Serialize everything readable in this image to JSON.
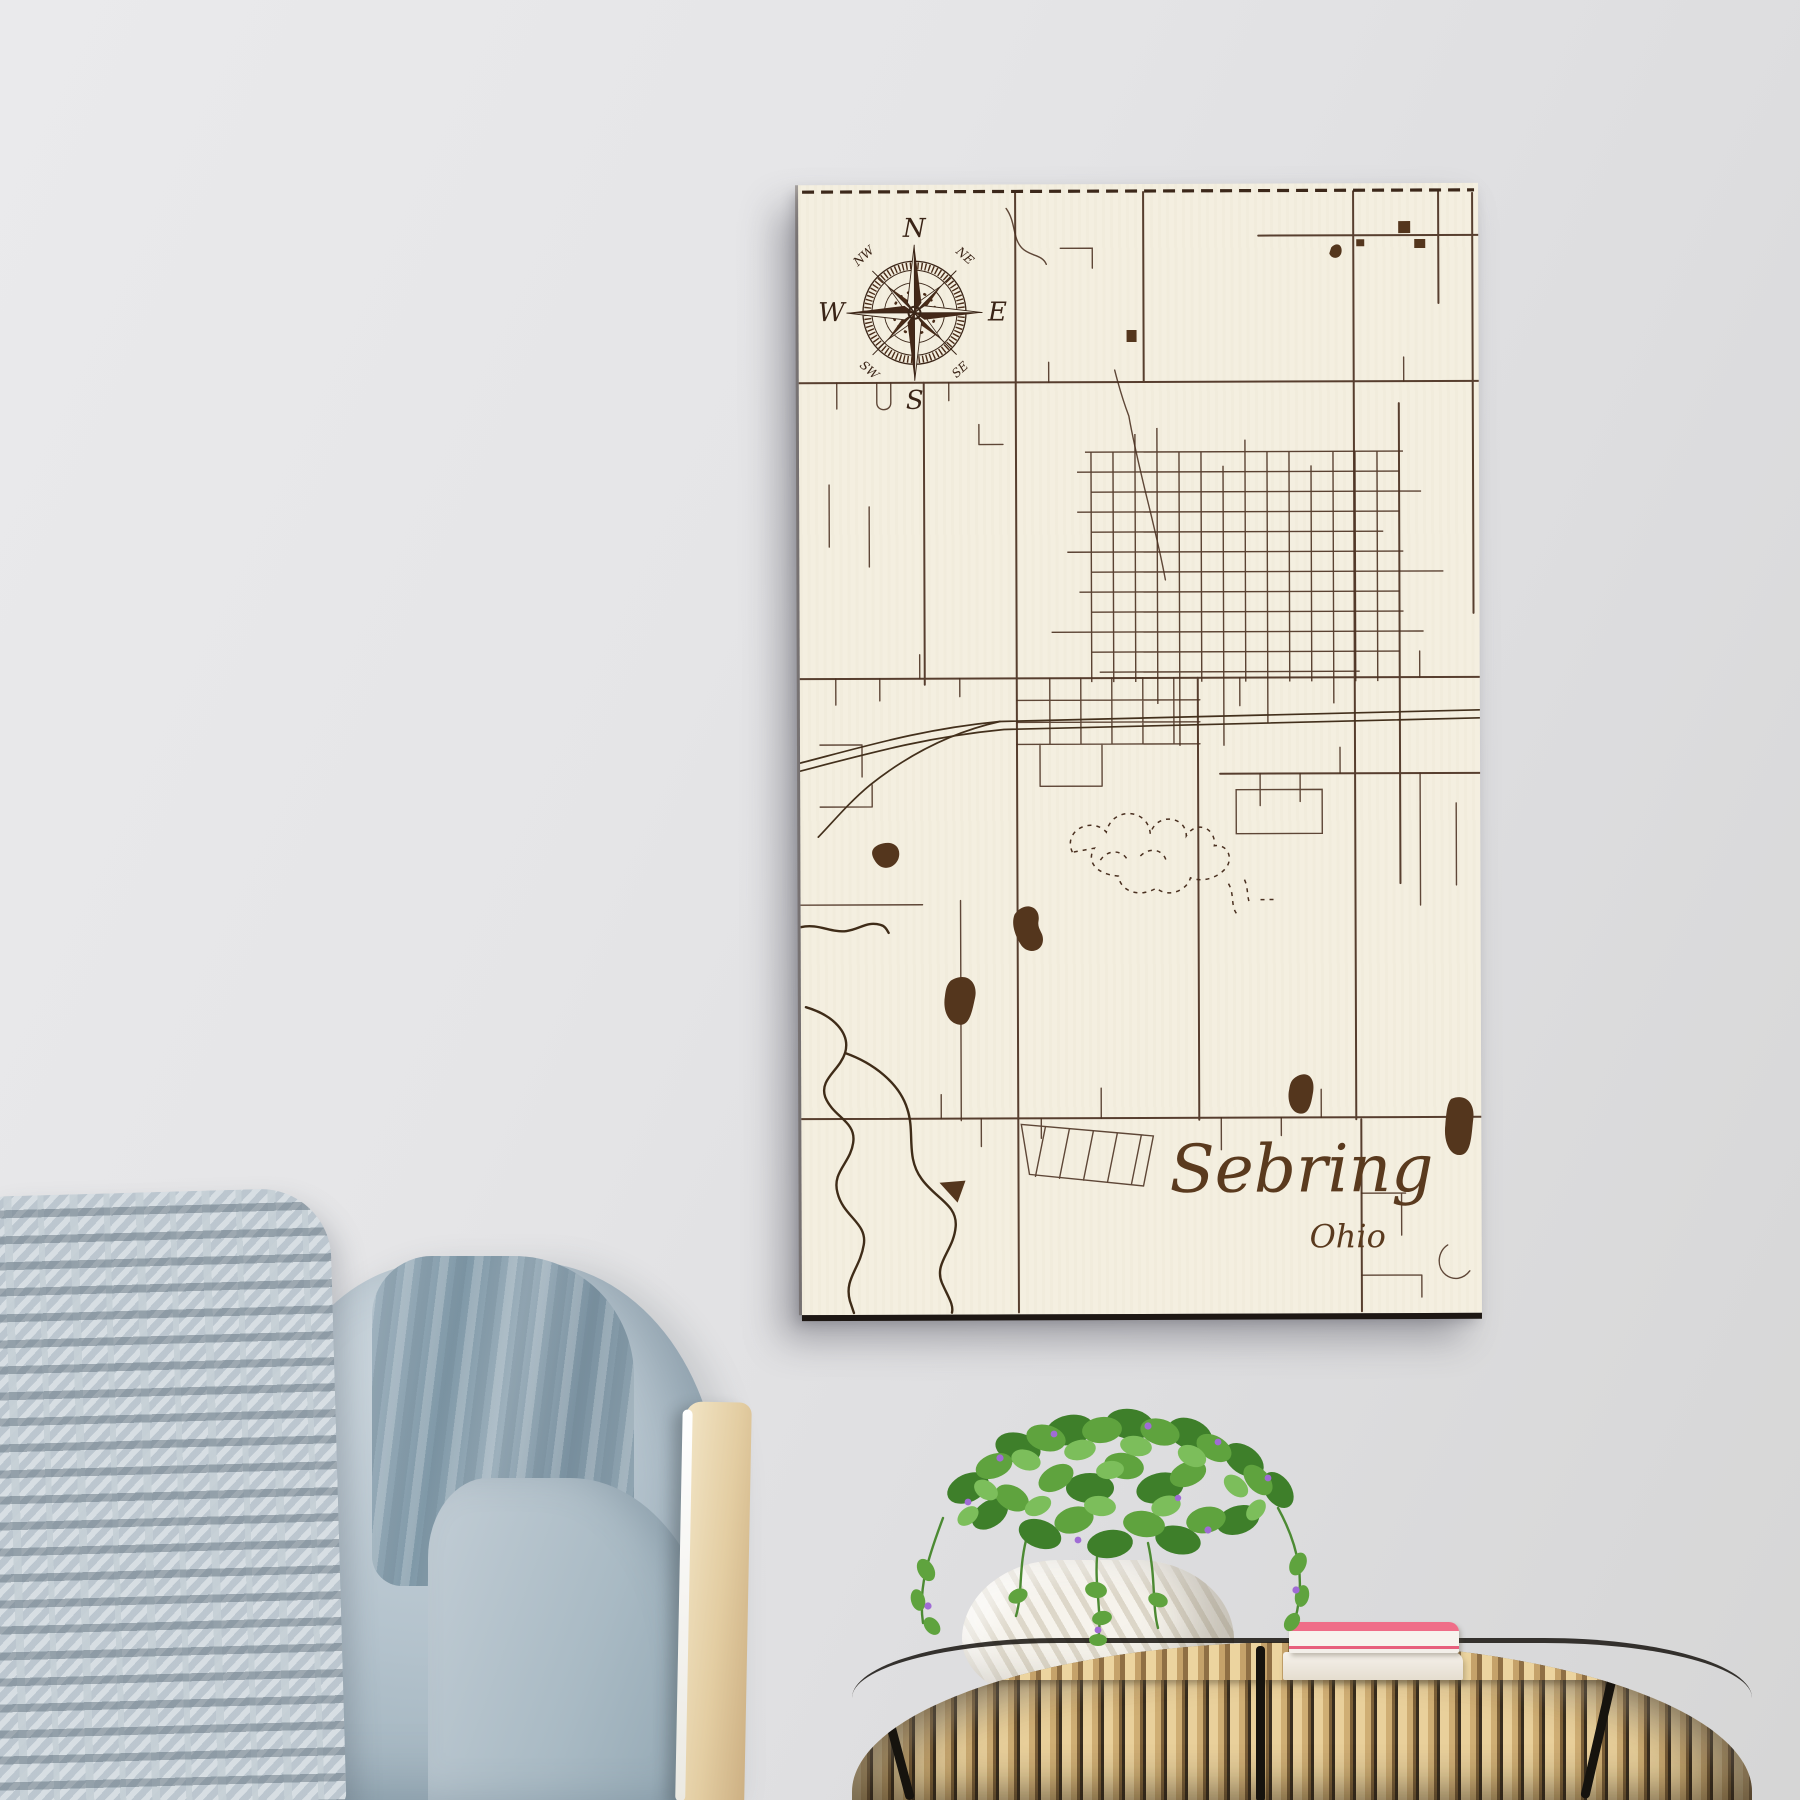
{
  "artwork": {
    "title": "Sebring",
    "subtitle": "Ohio",
    "compass": {
      "n": "N",
      "e": "E",
      "s": "S",
      "w": "W",
      "nw": "NW",
      "ne": "NE",
      "sw": "SW",
      "se": "SE"
    },
    "colors": {
      "board_cream": "#f4efe0",
      "engraving_brown": "#4a3020",
      "walnut_dark": "#54361d",
      "edge_dark": "#1d1713"
    }
  },
  "scene": {
    "wall_color": "#e4e4e6",
    "couch": {
      "knit_pillow_color": "#c6d0d7",
      "cushion_color": "#a9bac5",
      "slub_pillow_color": "#8099a8",
      "frame_wood_color": "#e3cda2",
      "piping_color": "#ffffff"
    },
    "side_table": {
      "rattan_color": "#cfae74",
      "strap_color": "#16130e"
    },
    "books": {
      "top_cover_color": "#e75f7d",
      "pages_color": "#f7f3ee",
      "bottom_book_color": "#efe8dc"
    },
    "plant": {
      "pot_color": "#f0ece2",
      "leaf_green": "#5fa33e",
      "flower_purple": "#a06cd5"
    }
  }
}
